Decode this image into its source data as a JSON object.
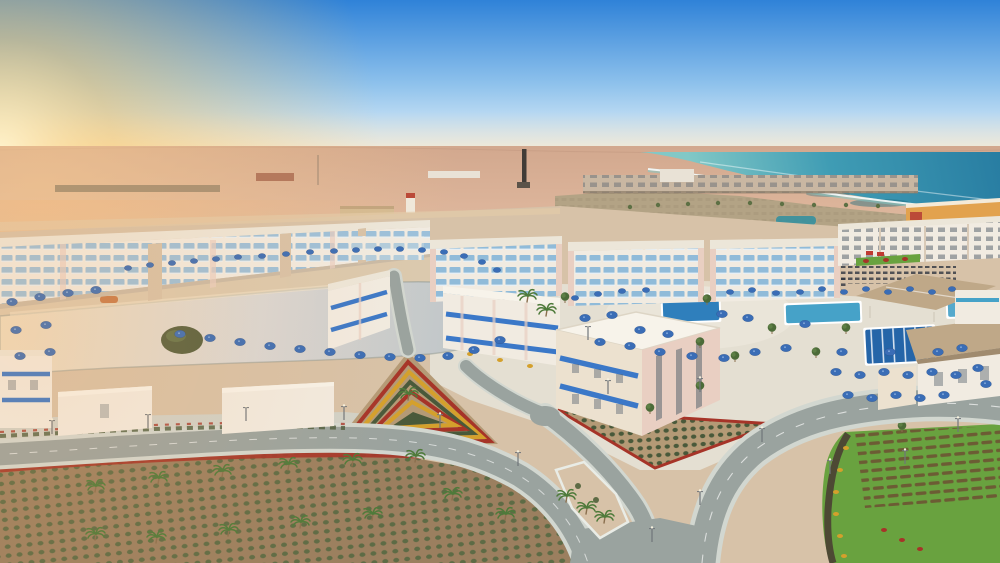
{
  "image": {
    "kind": "aerial-photograph",
    "subject": "Seaside desert resort complex at golden hour",
    "description": "High-angle drone view of a newly built beachfront resort. Rows of white low-rise hotel blocks with blue glass balconies and bright blue awnings surround a large silvery lagoon pool that reflects warm sunset light. Pool decks are dotted with dozens of dark-blue parasols and small rectangular pools. Landscaped grounds include a triangular red-and-yellow flowerbed, geometric shrub gardens, young palm trees and a green lawn with planting rows. Empty light-gray roads curve through the grounds. Flat desert stretches to the horizon on the left under an orange sunset glow; the turquoise sea with a white curving surf line fills the upper right, with a long shoreline construction row and a distant industrial chimney on the horizon.",
    "time_of_day": "sunset / golden hour",
    "weather": "clear sky",
    "no_text_visible": true
  },
  "inventory": {
    "sky": [
      "blue gradient sky",
      "orange sun glow at left horizon",
      "warm haze band"
    ],
    "sea": [
      "turquoise sea",
      "white surf arcs",
      "dark reef patches",
      "curving shoreline"
    ],
    "horizon_objects": [
      "industrial chimney",
      "shoreline construction row",
      "distant building clusters",
      "red service tower",
      "desert fort structure"
    ],
    "pools": [
      "large lagoon pool with green islets",
      "dark blue rectangular pool",
      "aqua rectangular pool",
      "lap pool with lanes",
      "small aqua pool"
    ],
    "buildings": [
      "left townhouse band with blue balconies",
      "three central hotel blocks",
      "street-side blocks with blue awnings",
      "large cream building with pink faces",
      "white flat-roof villas",
      "right modern row",
      "orange back row",
      "tan gable-roof buildings"
    ],
    "structures": [
      "tan beach pavilion",
      "sunbed rows"
    ],
    "landscape": [
      "triangular flowerbed with concentric red/yellow rows",
      "shrub-grid triangle garden",
      "large shrub-grid garden with red flower ribbon",
      "lawn with brown planting rows",
      "mulch border with yellow bushes",
      "palm trees",
      "olive trees",
      "street lamps"
    ],
    "roads": [
      "left curving road",
      "main S-curve road",
      "branch road",
      "narrow street between blocks",
      "sidewalk island with palms"
    ],
    "approx_counts": {
      "parasols": 70,
      "palms": 20,
      "street_lamps": 15,
      "olive_trees": 7
    }
  },
  "palette": {
    "sky_top": "#2f82d8",
    "sky_mid": "#8fc2ec",
    "sky_horizon": "#eef6fa",
    "sun_glow": "#ffc763",
    "sun_core": "#fff3cc",
    "warm_haze": "#ffd9a0",
    "desert": "#dcb49a",
    "desert_far": "#d2a88e",
    "desert_warm": "#f2c48e",
    "sea_deep": "#287da2",
    "sea_mid": "#3f9cb4",
    "sea_shallow": "#82c8c6",
    "surf": "#ffffff",
    "reef": "#1f6a7c",
    "scrub": "#b3a385",
    "scrub_green": "#74815a",
    "construction": "#c9b7a2",
    "wall_white": "#f1ebe1",
    "wall_cream": "#ece1cf",
    "wall_pink": "#e9cfc2",
    "wall_shadow": "#d9cab7",
    "roof_white": "#f7f3ea",
    "roof_light": "#ece6d9",
    "glass_blue": "#7fb2d8",
    "awning_blue": "#3b78c8",
    "window_dark": "#5a6670",
    "umbrella_blue": "#3a6db6",
    "pool_aqua": "#46a2c8",
    "pool_blue": "#2f7fbc",
    "lane_blue": "#2565a8",
    "lagoon_peach": "#eedcbe",
    "lagoon_silver": "#d9d7d5",
    "lagoon_deep": "#b9c1c4",
    "beach_sand": "#dbc9ae",
    "sand": "#d7c2a8",
    "deck": "#e9e4d8",
    "plaza": "#e4dfd2",
    "soil": "#9b7f5f",
    "soil_light": "#b49a76",
    "shrub": "#5d6b45",
    "hedge": "#49593a",
    "flower_red": "#a63428",
    "flower_yellow": "#d4a02c",
    "lawn": "#69a23f",
    "lawn_dark": "#517f31",
    "mulch": "#4a3f33",
    "road": "#9aa39f",
    "sidewalk": "#d2d7d0",
    "curb": "#e9ece6",
    "pavilion": "#bfa888",
    "pavilion_dark": "#a08b6f",
    "trunk": "#8a6f4e",
    "palm": "#4e7a3a",
    "island_green": "#57603f",
    "lamp": "#70757a",
    "orange_wall": "#e2a24e",
    "red_roof": "#bb4a38",
    "boat": "#c77b4a"
  }
}
